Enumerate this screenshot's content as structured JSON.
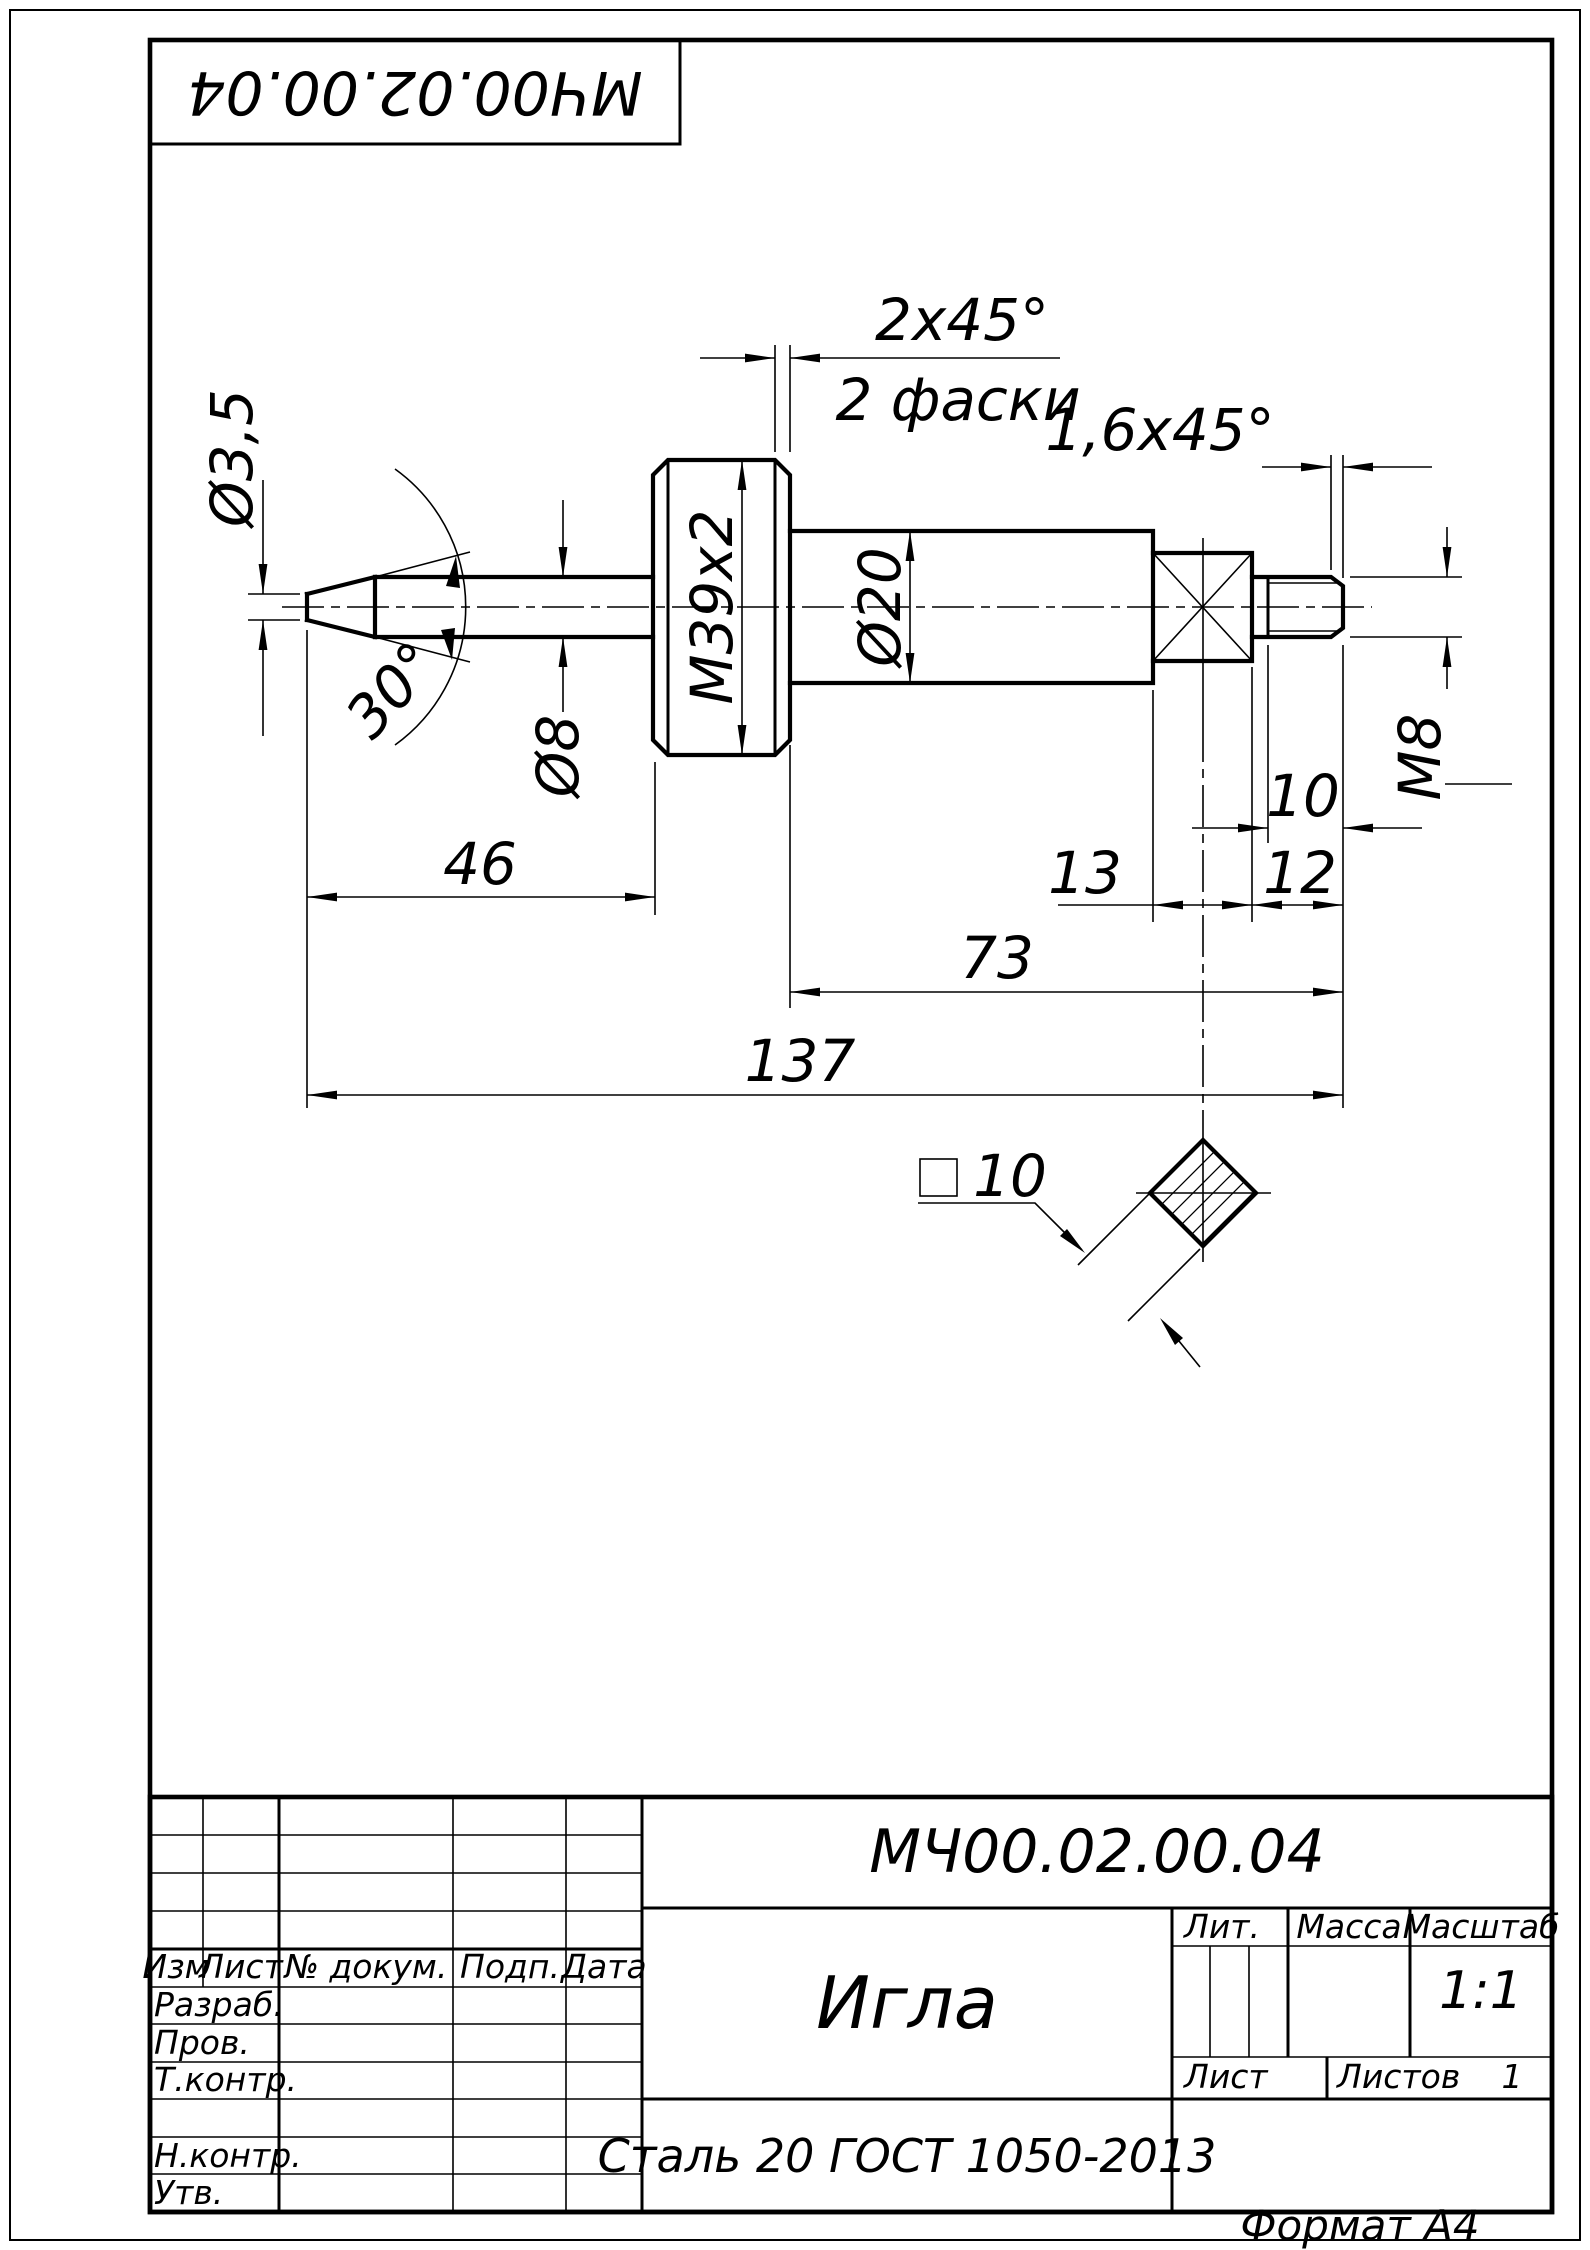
{
  "page": {
    "format": "Формат А4"
  },
  "corner_stamp": {
    "designation": "МЧ00.02.00.04"
  },
  "drawing": {
    "dims": {
      "tip_dia": "Ø3,5",
      "cone_angle": "30°",
      "shaft_dia": "Ø8",
      "head_thread": "M39x2",
      "head_chamfer": "2x45°",
      "head_chamfer_note": "2 фаски",
      "body_dia": "Ø20",
      "stud_chamfer": "1,6x45°",
      "stud_thread": "М8",
      "len_nose": "46",
      "len_square": "13",
      "len_stud": "12",
      "len_thread": "10",
      "len_body": "73",
      "len_total": "137",
      "square_size": "10"
    }
  },
  "title_block": {
    "designation": "МЧ00.02.00.04",
    "part_name": "Игла",
    "material": "Сталь 20 ГОСТ 1050-2013",
    "scale_value": "1:1",
    "sheets_value": "1",
    "labels": {
      "izm": "Изм",
      "list": "Лист",
      "doc_no": "№ докум.",
      "podp": "Подп.",
      "data": "Дата",
      "razrab": "Разраб.",
      "prov": "Пров.",
      "t_kontr": "Т.контр.",
      "n_kontr": "Н.контр.",
      "utv": "Утв.",
      "lit": "Лит.",
      "massa": "Масса",
      "masshtab": "Масштаб",
      "sheet": "Лист",
      "sheets": "Листов"
    }
  }
}
